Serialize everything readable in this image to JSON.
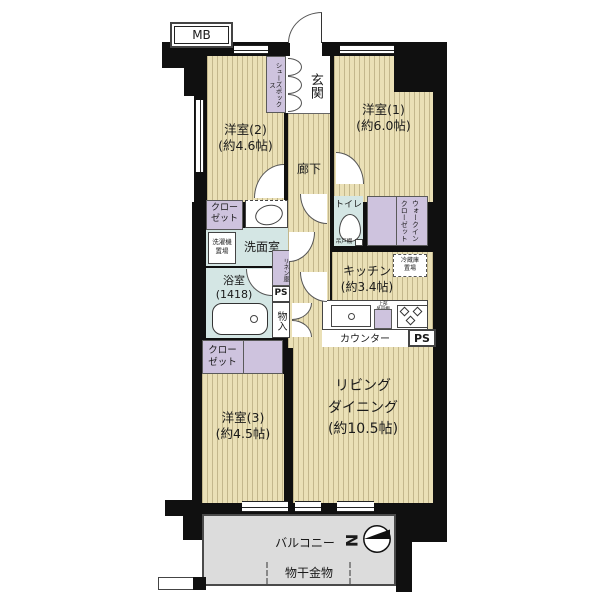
{
  "plan": {
    "mb": "MB",
    "entrance": {
      "genkan": "玄関",
      "shoebox": "シューズボックス"
    },
    "hallway": "廊下",
    "bedroom1": {
      "name": "洋室(1)",
      "area": "(約6.0帖)"
    },
    "bedroom2": {
      "name": "洋室(2)",
      "area": "(約4.6帖)",
      "closet": "クロー\nゼット"
    },
    "bedroom3": {
      "name": "洋室(3)",
      "area": "(約4.5帖)",
      "closet": "クロー\nゼット"
    },
    "living": {
      "text": "リビング\nダイニング\n(約10.5帖)"
    },
    "kitchen": {
      "name": "キッチン",
      "area": "(約3.4帖)",
      "counter": "カウンター",
      "upper_cabinet": "上部\n吊戸棚",
      "fridge": "冷蔵庫\n置場",
      "ps": "PS"
    },
    "washroom": {
      "name": "洗面室",
      "washer": "洗濯機\n置場"
    },
    "bath": {
      "name": "浴室",
      "size": "(1418)"
    },
    "toilet": {
      "name": "トイレ",
      "cabinet": "吊戸棚"
    },
    "wic": {
      "text": "ウォークイン\nクローゼット"
    },
    "storage": {
      "monoire": "物入",
      "linen": "リネン庫",
      "ps": "PS"
    },
    "balcony": {
      "name": "バルコニー",
      "drying": "物干金物"
    },
    "compass": {
      "north": "N"
    },
    "colors": {
      "wall": "#101010",
      "floor": "#eae0b6",
      "floor_stripe": "#c3b78c",
      "closet": "#cec3de",
      "wet_area": "#d4e6e4",
      "balcony": "#dcdcdc"
    }
  }
}
